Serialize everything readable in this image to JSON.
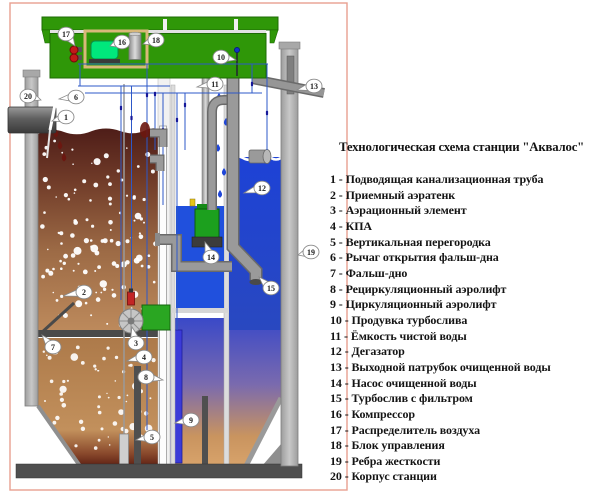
{
  "legend": {
    "title": "Технологическая схема станции \"Аквалос\"",
    "items": [
      "1 - Подводящая канализационная труба",
      "2 - Приемный аэратенк",
      "3 - Аэрационный элемент",
      "4 - КПА",
      "5 - Вертикальная перегородка",
      "6 - Рычаг открытия фальш-дна",
      "7 - Фальш-дно",
      "8 - Рециркуляционный аэролифт",
      "9 - Циркуляционный аэролифт",
      "10 - Продувка турбослива",
      "11 - Ёмкость чистой воды",
      "12 - Дегазатор",
      "13 - Выходной патрубок очищенной воды",
      "14 - Насос очищенной воды",
      "15 - Турбослив с фильтром",
      "16 - Компрессор",
      "17 - Распределитель воздуха",
      "18 - Блок управления",
      "19 - Ребра жесткости",
      "20 - Корпус станции"
    ]
  },
  "callouts": [
    "1",
    "2",
    "3",
    "4",
    "5",
    "6",
    "7",
    "8",
    "9",
    "10",
    "11",
    "12",
    "13",
    "14",
    "15",
    "16",
    "17",
    "18",
    "19",
    "20"
  ],
  "colors": {
    "lid_green": "#2f9708",
    "compressor_green": "#00e87c",
    "sewage_brown": "#6f3a28",
    "clean_water_blue": "#1d42d6",
    "frame_salmon": "#e8a090",
    "hull_gray": "#b3b3b3"
  }
}
